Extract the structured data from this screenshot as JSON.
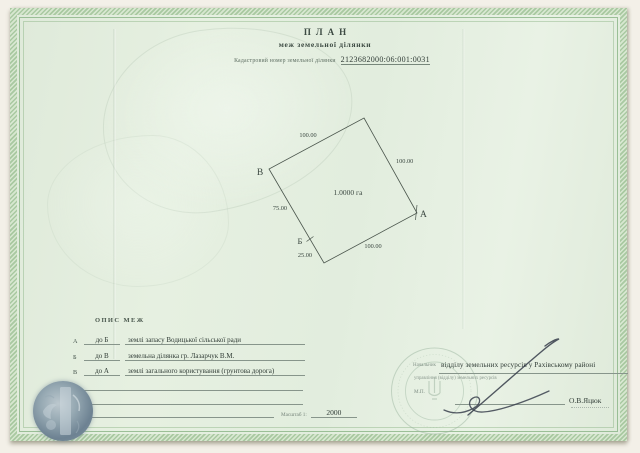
{
  "document": {
    "title_line1": "ПЛАН",
    "title_line2": "меж земельної ділянки",
    "cadastral_label": "Кадастровий номер земельної ділянки",
    "cadastral_number": "2123682000:06:001:0031"
  },
  "plot_diagram": {
    "area_label": "1.0000 га",
    "vertex_a": "А",
    "vertex_b": "Б",
    "vertex_v": "В",
    "side_lengths": {
      "top_left": "100.00",
      "top_right": "100.00",
      "bottom": "100.00",
      "left_upper": "75.00",
      "left_lower": "25.00"
    }
  },
  "boundaries": {
    "heading": "ОПИС МЕЖ",
    "rows": [
      {
        "from": "А",
        "to": "до Б",
        "description": "землі запасу Водицької сільської ради"
      },
      {
        "from": "Б",
        "to": "до В",
        "description": "земельна ділянка гр. Лазарчук В.М."
      },
      {
        "from": "В",
        "to": "до А",
        "description": "землі загального користування (грунтова дорога)"
      },
      {
        "from": "Г",
        "to": "",
        "description": ""
      },
      {
        "from": "Д",
        "to": "",
        "description": ""
      },
      {
        "from": "Е",
        "to": "",
        "description": ""
      }
    ],
    "scale_label": "Масштаб 1:",
    "scale_value": "2000"
  },
  "signature_block": {
    "position_label": "Начальник",
    "position_filled": "відділу земельних ресурсів у Рахівському районі",
    "position_sub": "управління (відділу) земельних ресурсів",
    "stamp_label": "М.П.",
    "signatory_name": "О.В.Яцюк"
  },
  "colors": {
    "paper_green": "#e3eedf",
    "border_green": "#a9c9a1",
    "ink": "#2f3b35",
    "form_print": "#85948a",
    "seal_green": "#9cb6a0",
    "stamp_blue": "#6d8292"
  }
}
